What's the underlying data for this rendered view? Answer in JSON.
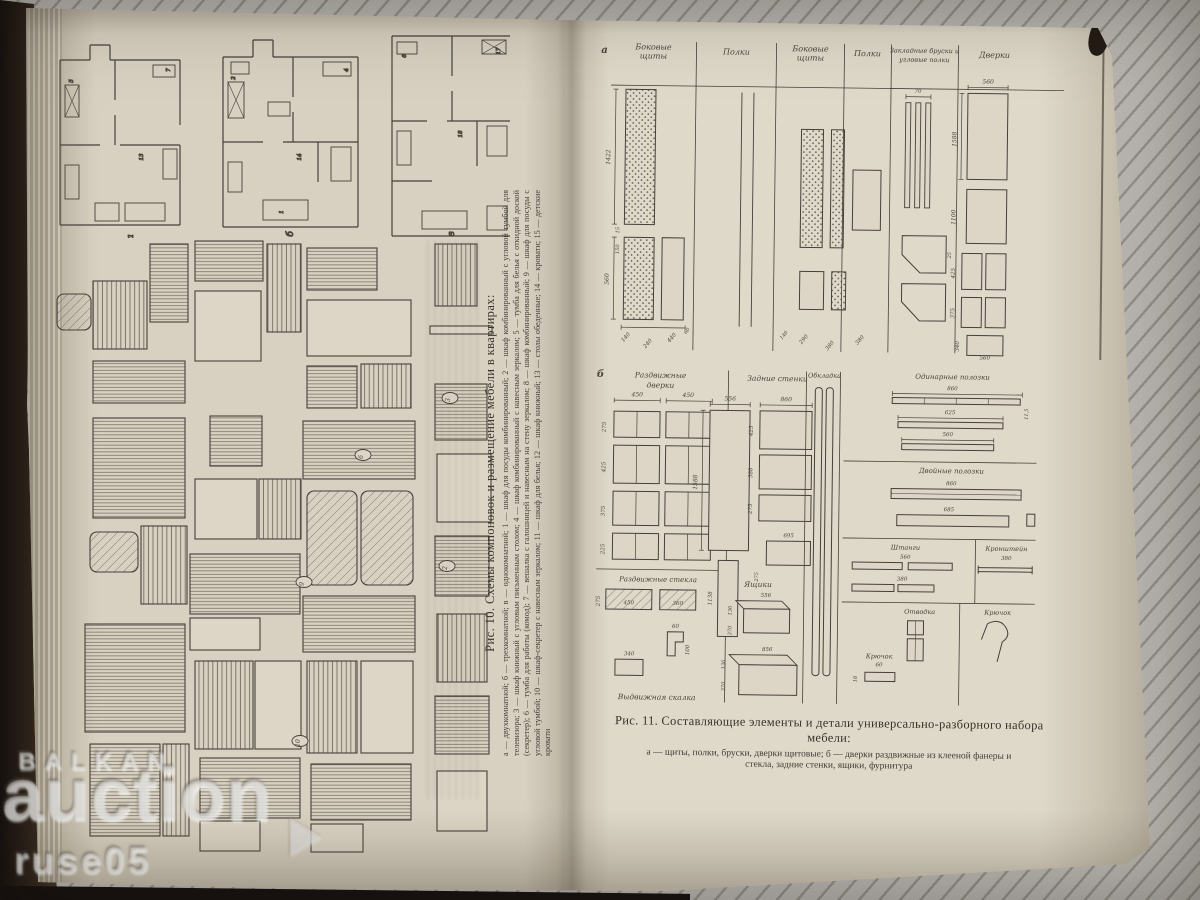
{
  "watermark": {
    "line1": "BALKAN",
    "line2": "auction",
    "line3": "ruse05"
  },
  "left_page": {
    "plan_labels": [
      "а",
      "б",
      "в"
    ],
    "plan_numbers": [
      "5",
      "7",
      "13",
      "2",
      "4",
      "14",
      "1",
      "6",
      "17",
      "18"
    ],
    "item_tags": [
      "3",
      "6",
      "9",
      "2",
      "10"
    ],
    "fig10_caption": {
      "title": "Рис. 10. Схемы компоновок и размещение мебели в квартирах:",
      "legend": "а — двухкомнатной; б — трехкомнатной; в — однокомнатной; 1 — шкаф для посуды комбинированный; 2 — шкаф комбинированный с угловой тумбой для телевизора; 3 — шкаф книжный с угловым письменным столом; 4 — шкаф комбинированный с навесным зеркалом; 5 — тумба для белья с откидной доской (секретер); 6 — тумба для работы (комод); 7 — вешалка с галошницей и навесным на стену зеркалом; 8 — шкаф комбинированный; 9 — шкаф для посуды с угловой тумбой; 10 — шкаф-секретер с навесным зеркалом; 11 — шкаф для белья; 12 — шкаф книжный; 13 — столы обеденные; 14 — кровати; 15 — детские кровати"
    }
  },
  "right_page": {
    "fig_a": {
      "part_label": "а",
      "columns": [
        "Боковые щиты",
        "Полки",
        "Боковые щиты",
        "Полки",
        "Закладные бруски и угловые полки",
        "Дверки"
      ],
      "dims": [
        "560",
        "1588",
        "1100",
        "425",
        "375",
        "340",
        "560",
        "1422",
        "560",
        "150",
        "15",
        "140",
        "240",
        "440",
        "60",
        "290",
        "380",
        "140",
        "70",
        "25",
        "380"
      ]
    },
    "fig_b": {
      "part_label": "б",
      "labels": [
        "Раздвижные дверки",
        "Задние стенки",
        "Обкладка",
        "Одинарные полозки",
        "Двойные полозки",
        "Штанги",
        "Кронштейн",
        "Отводка",
        "Крючок",
        "Крючок",
        "Раздвижные стекла",
        "Ящики",
        "Выдвижная скалка"
      ],
      "dims": [
        "450",
        "450",
        "275",
        "425",
        "375",
        "225",
        "556",
        "1588",
        "860",
        "425",
        "388",
        "275",
        "695",
        "1138",
        "275",
        "860",
        "625",
        "560",
        "11,5",
        "860",
        "685",
        "560",
        "380",
        "380",
        "450",
        "360",
        "275",
        "340",
        "60",
        "100",
        "556",
        "136",
        "370",
        "856",
        "136",
        "370",
        "60",
        "18"
      ]
    },
    "fig11_caption": {
      "title_line1": "Рис. 11. Составляющие элементы и детали универсально-разборного набора",
      "title_line2": "мебели:",
      "legend_line1": "а — щиты, полки, бруски, дверки щитовые; б — дверки раздвижные из клееной фанеры и",
      "legend_line2": "стекла, задние стенки, ящики, фурнитура"
    }
  }
}
